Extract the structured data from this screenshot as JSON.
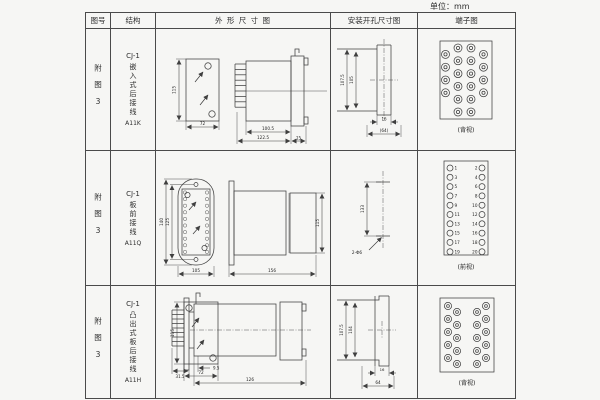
{
  "unit_label": "单位：mm",
  "colors": {
    "line": "#3f3f3f",
    "border": "#4a4a4a",
    "background": "#f6f6f4"
  },
  "table": {
    "headers": {
      "fig": "图号",
      "structure": "结构",
      "outline": "外 形 尺 寸 图",
      "install": "安装开孔尺寸图",
      "terminal": "端子图"
    },
    "rows": [
      {
        "fig": "附图3",
        "model": "CJ-1",
        "desc": "嵌入式后接线",
        "code": "A11K",
        "outline": {
          "front_h": "115",
          "front_w": "72",
          "body_len": "100.5",
          "total_len": "122.5",
          "flange_w": "15"
        },
        "install": {
          "outer_h": "107.5",
          "inner_h": "105",
          "slot_w": "16",
          "outer_w": "(64)"
        },
        "terminal": {
          "view": "(背视)"
        }
      },
      {
        "fig": "附图3",
        "model": "CJ-1",
        "desc": "板前接线",
        "code": "A11Q",
        "outline": {
          "outer_h": "140",
          "inner_h": "125",
          "front_w": "105",
          "total_len": "156",
          "rear_h": "115"
        },
        "install": {
          "hole_pitch": "133",
          "hole_label": "2-Φ6"
        },
        "terminal": {
          "view": "(前视)",
          "numbers": [
            "1",
            "2",
            "3",
            "4",
            "5",
            "6",
            "7",
            "8",
            "9",
            "10",
            "11",
            "12",
            "13",
            "14",
            "15",
            "16",
            "17",
            "18",
            "19",
            "20"
          ]
        }
      },
      {
        "fig": "附图3",
        "model": "CJ-1",
        "desc": "凸出式板后接线",
        "code": "A11H",
        "outline": {
          "front_h": "115",
          "front_w": "72",
          "proj_len": "31.5",
          "gap_len": "9.5",
          "total_len": "126"
        },
        "install": {
          "outer_h": "107.5",
          "inner_h": "104",
          "slot_w": "16",
          "outer_w": "64"
        },
        "terminal": {
          "view": "(背视)"
        }
      }
    ]
  }
}
